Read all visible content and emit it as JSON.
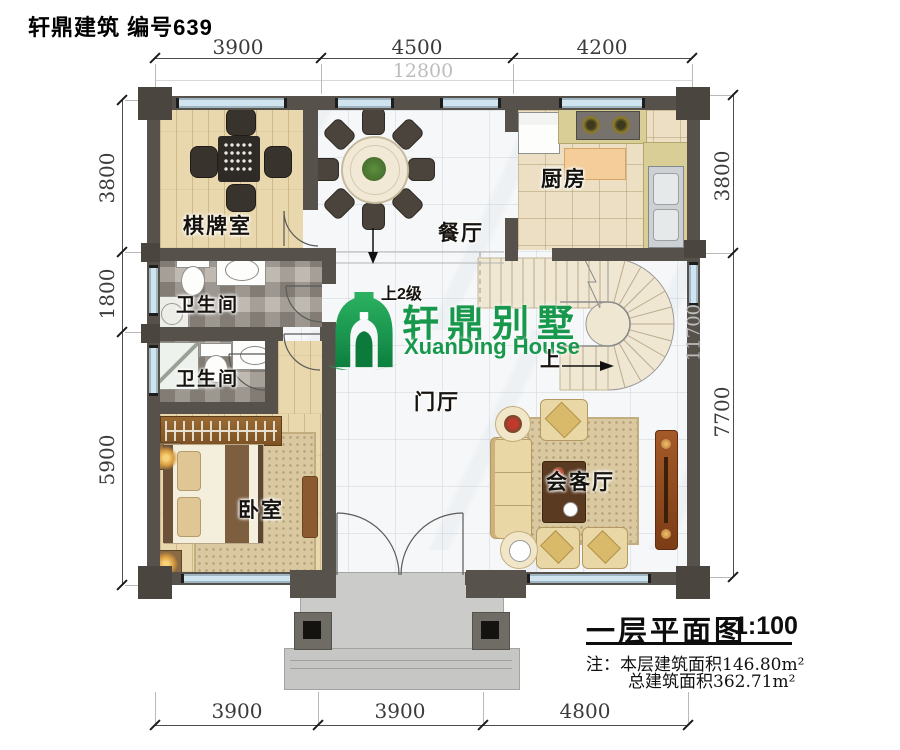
{
  "header": {
    "title": "轩鼎建筑 编号639"
  },
  "logo": {
    "cn": "轩鼎别墅",
    "en": "XuanDing House",
    "green": "#17984d"
  },
  "rooms": {
    "chess": "棋牌室",
    "dining": "餐厅",
    "kitchen": "厨房",
    "bath_upper": "卫生间",
    "bath_lower": "卫生间",
    "foyer": "门厅",
    "bedroom": "卧室",
    "living": "会客厅"
  },
  "stair": {
    "up_two": "上2级",
    "up": "上"
  },
  "dimensions": {
    "top": [
      "3900",
      "4500",
      "4200"
    ],
    "top_total": "12800",
    "left": [
      "3800",
      "1800",
      "5900"
    ],
    "right": [
      "3800",
      "7700"
    ],
    "right_inner": "11700",
    "bottom": [
      "3900",
      "3900",
      "4800"
    ]
  },
  "titleblock": {
    "title": "一层平面图",
    "scale": "1:100",
    "note_label": "注：",
    "note1": "本层建筑面积146.80m²",
    "note2": "总建筑面积362.71m²"
  },
  "colors": {
    "wall": "#56514b",
    "window": "#cfe4ef",
    "accent_green": "#17984d"
  }
}
